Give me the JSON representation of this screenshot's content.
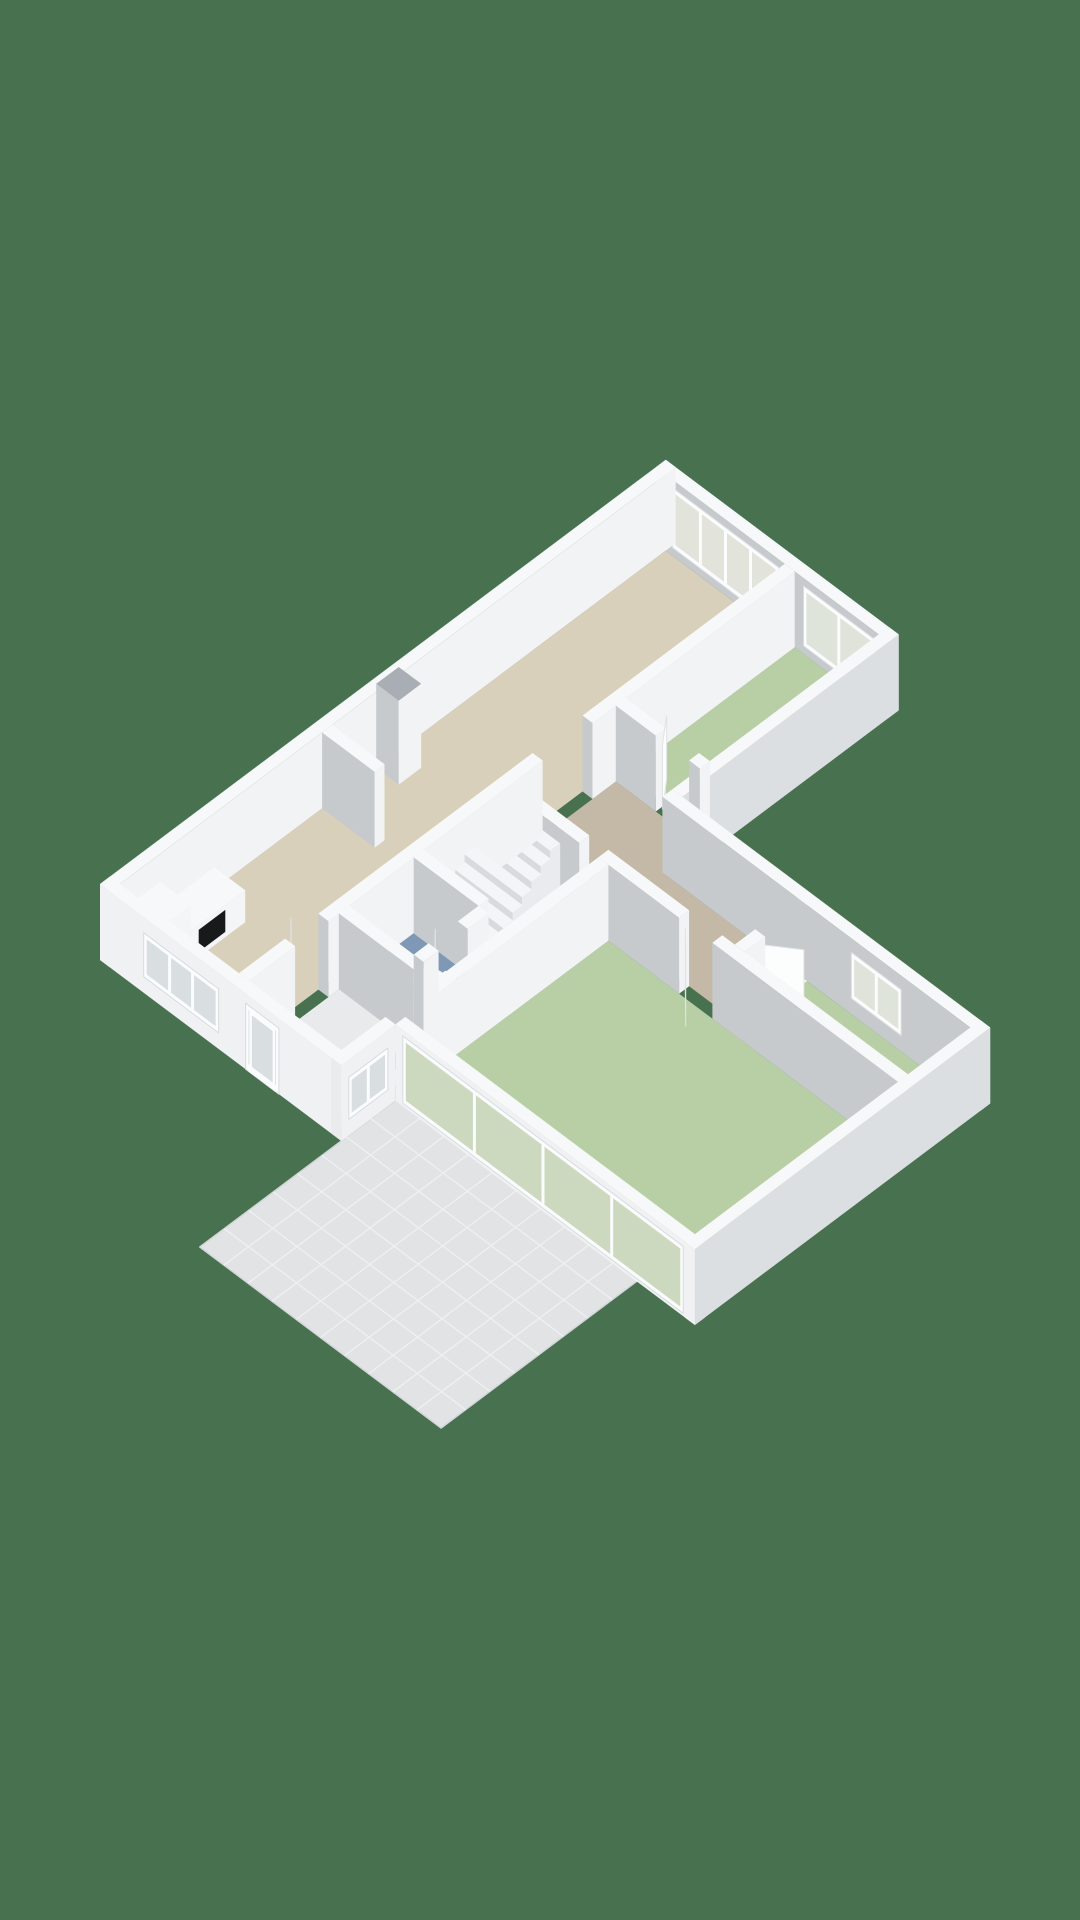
{
  "scene": {
    "width": 1080,
    "height": 1920,
    "background": "#48714F"
  },
  "projection": {
    "ox": 100,
    "oy": 960,
    "su": 41.6,
    "sv": 31.2,
    "wallH": 76
  },
  "palette": {
    "background": "#48714F",
    "topFace": "#f7f8f9",
    "seBright": "#f2f3f4",
    "swGray": "#c6cacd",
    "extLit": "#eff1f2",
    "extSE": "#dcdfe1",
    "extCap": "#e9ebed",
    "chimneyTop": "#a8aeb3",
    "floorLiving": "#d8d0bb",
    "floorHall": "#c4b9a7",
    "floorGreen": "#b8cfa6",
    "floorBlue": "#7e98b6",
    "floorEntrance": "#e9eaeb",
    "patio": "#e1e3e5",
    "patioGrout": "#eef0f1",
    "patioEdge": "#d4d7d9",
    "glassLiving": "#e2e3db",
    "glassGreen": "#dfe4da",
    "glassSlider": "#ccd9bf",
    "glassMisc": "#d9dee0",
    "frame": "#fbfcfd",
    "frameEdge": "#d9dcde",
    "leaf": "#fcfdfd",
    "leafEdge": "#e0e3e5",
    "oven": "#18191b",
    "toilet": "#fafbfc",
    "toiletShadow": "#dfe3e5",
    "stepTop": "#f4f5f6",
    "stepSE": "#e9ebee",
    "stepSW": "#d8dbde",
    "rackTop": "#f1f2f3",
    "rackSE": "#e4e6e8",
    "rackSW": "#d6d9db"
  },
  "patioSlab": {
    "name": "patio-tiles",
    "poly": [
      [
        -3.4,
        5.8
      ],
      [
        1.3,
        5.8
      ],
      [
        1.3,
        11.6
      ],
      [
        -3.4,
        11.6
      ]
    ],
    "uRange": [
      -3.4,
      1.3
    ],
    "vRange": [
      5.8,
      11.6
    ],
    "uStep": 0.5875,
    "vStep": 0.58
  },
  "floors": [
    {
      "name": "living-room-floor",
      "color": "floorLiving",
      "poly": [
        [
          0.24,
          0.24
        ],
        [
          13.36,
          0.24
        ],
        [
          13.36,
          3.1
        ],
        [
          0.24,
          3.1
        ]
      ]
    },
    {
      "name": "entrance-hall-floor",
      "color": "floorEntrance",
      "poly": [
        [
          0.24,
          3.34
        ],
        [
          6.42,
          3.34
        ],
        [
          6.42,
          5.56
        ],
        [
          0.24,
          5.56
        ]
      ]
    },
    {
      "name": "bedroom1-floor",
      "color": "floorGreen",
      "poly": [
        [
          9.3,
          3.34
        ],
        [
          13.36,
          3.34
        ],
        [
          13.36,
          5.36
        ],
        [
          9.3,
          5.36
        ]
      ]
    },
    {
      "name": "hallway-floor",
      "color": "floorHall",
      "poly": [
        [
          6.66,
          3.34
        ],
        [
          9.06,
          3.34
        ],
        [
          9.06,
          5.36
        ],
        [
          8.16,
          5.36
        ],
        [
          8.16,
          8.6
        ],
        [
          6.66,
          8.6
        ]
      ]
    },
    {
      "name": "wc-floor",
      "color": "floorBlue",
      "poly": [
        [
          2.64,
          3.34
        ],
        [
          4.2,
          3.34
        ],
        [
          4.2,
          4.9
        ],
        [
          2.64,
          4.9
        ]
      ]
    },
    {
      "name": "bedroom3-floor",
      "color": "floorGreen",
      "poly": [
        [
          1.54,
          5.8
        ],
        [
          6.42,
          5.8
        ],
        [
          6.42,
          12.76
        ],
        [
          1.54,
          12.76
        ]
      ]
    },
    {
      "name": "bedroom2-floor",
      "color": "floorGreen",
      "poly": [
        [
          6.66,
          8.84
        ],
        [
          8.16,
          8.84
        ],
        [
          8.16,
          12.76
        ],
        [
          6.66,
          12.76
        ]
      ]
    }
  ],
  "walls": [
    {
      "name": "exterior-nw-wall",
      "rect": [
        0,
        0,
        13.6,
        0.24
      ],
      "colors": {
        "se": "seBright",
        "sw": "extCap"
      }
    },
    {
      "name": "exterior-ne-wall",
      "rect": [
        13.36,
        0,
        13.6,
        5.6
      ],
      "colors": {
        "sw": "swGray",
        "se": "extSE"
      },
      "windows": [
        {
          "axis": "v",
          "at": 13.36,
          "range": [
            0.4,
            2.95
          ],
          "z": [
            8,
            68
          ],
          "panes": 4,
          "glass": "glassLiving"
        },
        {
          "axis": "v",
          "at": 13.36,
          "range": [
            3.55,
            5.25
          ],
          "z": [
            8,
            68
          ],
          "panes": 2,
          "glass": "glassGreen"
        }
      ]
    },
    {
      "name": "exterior-se-main-wall",
      "rect": [
        8.4,
        5.36,
        13.6,
        5.6
      ],
      "colors": {
        "se": "extSE",
        "sw": "swGray"
      }
    },
    {
      "name": "exterior-ne-wing-wall",
      "rect": [
        8.16,
        5.36,
        8.4,
        13.0
      ],
      "colors": {
        "sw": "swGray",
        "se": "extSE"
      },
      "windows": [
        {
          "axis": "v",
          "at": 8.16,
          "range": [
            9.9,
            11.1
          ],
          "z": [
            16,
            62
          ],
          "panes": 2,
          "glass": "glassGreen"
        }
      ]
    },
    {
      "name": "exterior-se-wing-wall",
      "rect": [
        1.3,
        12.76,
        8.4,
        13.0
      ],
      "colors": {
        "se": "extSE",
        "sw": "extLit"
      }
    },
    {
      "name": "sliding-glass-wall",
      "rect": [
        1.3,
        5.8,
        1.54,
        13.0
      ],
      "colors": {
        "sw": "extLit",
        "se": "extSE"
      },
      "windows": [
        {
          "axis": "v",
          "at": 1.3,
          "range": [
            5.98,
            12.72
          ],
          "z": [
            3,
            70
          ],
          "panes": 4,
          "glass": "glassSlider"
        }
      ]
    },
    {
      "name": "exterior-entrance-se-wall",
      "rect": [
        0,
        5.56,
        1.3,
        5.8
      ],
      "colors": {
        "se": "extLit",
        "sw": "extCap"
      },
      "windows": [
        {
          "axis": "u",
          "at": 5.8,
          "range": [
            0.18,
            1.12
          ],
          "z": [
            16,
            58
          ],
          "panes": 2,
          "glass": "glassMisc"
        }
      ]
    },
    {
      "name": "exterior-sw-wall",
      "rect": [
        0,
        0,
        0.24,
        5.8
      ],
      "colors": {
        "sw": "extLit",
        "se": "extCap"
      },
      "windows": [
        {
          "axis": "v",
          "at": 0,
          "range": [
            1.05,
            2.85
          ],
          "z": [
            16,
            60
          ],
          "panes": 3,
          "glass": "glassMisc"
        },
        {
          "axis": "v",
          "at": 0,
          "range": [
            3.5,
            4.3
          ],
          "z": [
            0,
            66
          ],
          "panes": 1,
          "glass": "glassMisc",
          "door": true
        }
      ]
    },
    {
      "name": "partition-living-a",
      "rect": [
        0.24,
        3.1,
        1.35,
        3.34
      ]
    },
    {
      "name": "partition-living-b",
      "rect": [
        2.15,
        3.1,
        7.3,
        3.34
      ]
    },
    {
      "name": "partition-living-c",
      "rect": [
        8.5,
        3.1,
        13.36,
        3.34
      ]
    },
    {
      "name": "bedroom1-west-wall-a",
      "rect": [
        9.06,
        3.34,
        9.3,
        4.3
      ]
    },
    {
      "name": "bedroom1-west-wall-b",
      "rect": [
        9.06,
        5.1,
        9.3,
        5.36
      ]
    },
    {
      "name": "wc-east-wall",
      "rect": [
        4.2,
        3.34,
        4.44,
        4.9
      ]
    },
    {
      "name": "wc-west-wall",
      "rect": [
        2.4,
        3.34,
        2.64,
        5.14
      ]
    },
    {
      "name": "wc-south-wall-a",
      "rect": [
        2.64,
        4.9,
        3.0,
        5.14
      ]
    },
    {
      "name": "wc-south-wall-b",
      "rect": [
        3.7,
        4.9,
        4.2,
        5.14
      ]
    },
    {
      "name": "bedroom3-north-wall",
      "rect": [
        1.54,
        5.56,
        6.42,
        5.8
      ]
    },
    {
      "name": "hall-west-wall-a",
      "rect": [
        6.42,
        3.34,
        6.66,
        5.1
      ]
    },
    {
      "name": "hall-west-wall-b",
      "rect": [
        6.42,
        5.56,
        6.66,
        7.5
      ]
    },
    {
      "name": "hall-west-wall-c",
      "rect": [
        6.42,
        8.3,
        6.66,
        12.76
      ]
    },
    {
      "name": "bedroom2-north-wall-a",
      "rect": [
        6.66,
        8.6,
        7.15,
        8.84
      ]
    },
    {
      "name": "bedroom2-north-wall-b",
      "rect": [
        7.85,
        8.6,
        8.16,
        8.84
      ]
    },
    {
      "name": "nw-wall-stub",
      "rect": [
        5.1,
        0.24,
        5.34,
        1.5
      ]
    }
  ],
  "chimney": {
    "name": "chimney-column",
    "rect": [
      6.4,
      0.24,
      6.94,
      0.78
    ],
    "h": 84,
    "top": "chimneyTop"
  },
  "kitchen": {
    "units": [
      {
        "name": "kitchen-tall-cabinet",
        "rect": [
          0.45,
          0.4,
          1.05,
          1.14
        ],
        "h": 58
      },
      {
        "name": "kitchen-counter",
        "rect": [
          1.05,
          0.4,
          2.35,
          1.14
        ],
        "h": 32,
        "panel": {
          "name": "oven-front",
          "u": [
            1.22,
            1.86
          ],
          "z": [
            6,
            28
          ],
          "color": "oven"
        }
      }
    ]
  },
  "stairs": {
    "name": "staircase",
    "u0": 4.5,
    "du": 0.226,
    "steps": 8,
    "v": [
      3.36,
      4.74
    ],
    "rise": 8.4,
    "entryStep": {
      "rect": [
        4.56,
        4.74,
        5.02,
        5.12
      ],
      "h": 8
    }
  },
  "toilet": {
    "name": "toilet",
    "center": [
      3.42,
      4.48
    ],
    "rx": 17,
    "ry": 10.5,
    "bowlH": 14,
    "tank": [
      3.18,
      4.64,
      3.66,
      4.88
    ],
    "tankH": 20
  },
  "shoeRack": {
    "rack": {
      "name": "shoe-rack",
      "rect": [
        1.05,
        5.1,
        2.28,
        5.5
      ],
      "h": 7
    },
    "shoes": [
      {
        "rect": [
          1.12,
          5.16,
          1.3,
          5.44
        ],
        "z0": 7,
        "h": 6,
        "color": "#6e3a2d"
      },
      {
        "rect": [
          1.4,
          5.16,
          1.58,
          5.44
        ],
        "z0": 7,
        "h": 6,
        "color": "#2f3133"
      },
      {
        "rect": [
          1.68,
          5.16,
          1.86,
          5.44
        ],
        "z0": 7,
        "h": 6,
        "color": "#7c4536"
      },
      {
        "rect": [
          1.96,
          5.16,
          2.14,
          5.44
        ],
        "z0": 7,
        "h": 6,
        "color": "#4a2e26"
      },
      {
        "rect": [
          1.22,
          4.78,
          1.4,
          5.04
        ],
        "z0": 0,
        "h": 6,
        "color": "#3a2d28"
      },
      {
        "rect": [
          1.5,
          4.78,
          1.68,
          5.04
        ],
        "z0": 0,
        "h": 6,
        "color": "#6e3a2d"
      }
    ]
  },
  "doorLeafs": [
    {
      "name": "door-leaf-living",
      "from": [
        1.4,
        3.2
      ],
      "to": [
        1.95,
        2.64
      ]
    },
    {
      "name": "door-leaf-bedroom1",
      "from": [
        9.18,
        4.34
      ],
      "to": [
        9.7,
        3.92
      ]
    },
    {
      "name": "door-leaf-bedroom3",
      "from": [
        6.52,
        7.55
      ],
      "to": [
        5.98,
        8.1
      ]
    },
    {
      "name": "door-leaf-bedroom2",
      "from": [
        7.18,
        8.74
      ],
      "to": [
        7.6,
        9.32
      ]
    },
    {
      "name": "door-leaf-wc",
      "from": [
        3.04,
        5.0
      ],
      "to": [
        3.5,
        4.56
      ]
    }
  ]
}
